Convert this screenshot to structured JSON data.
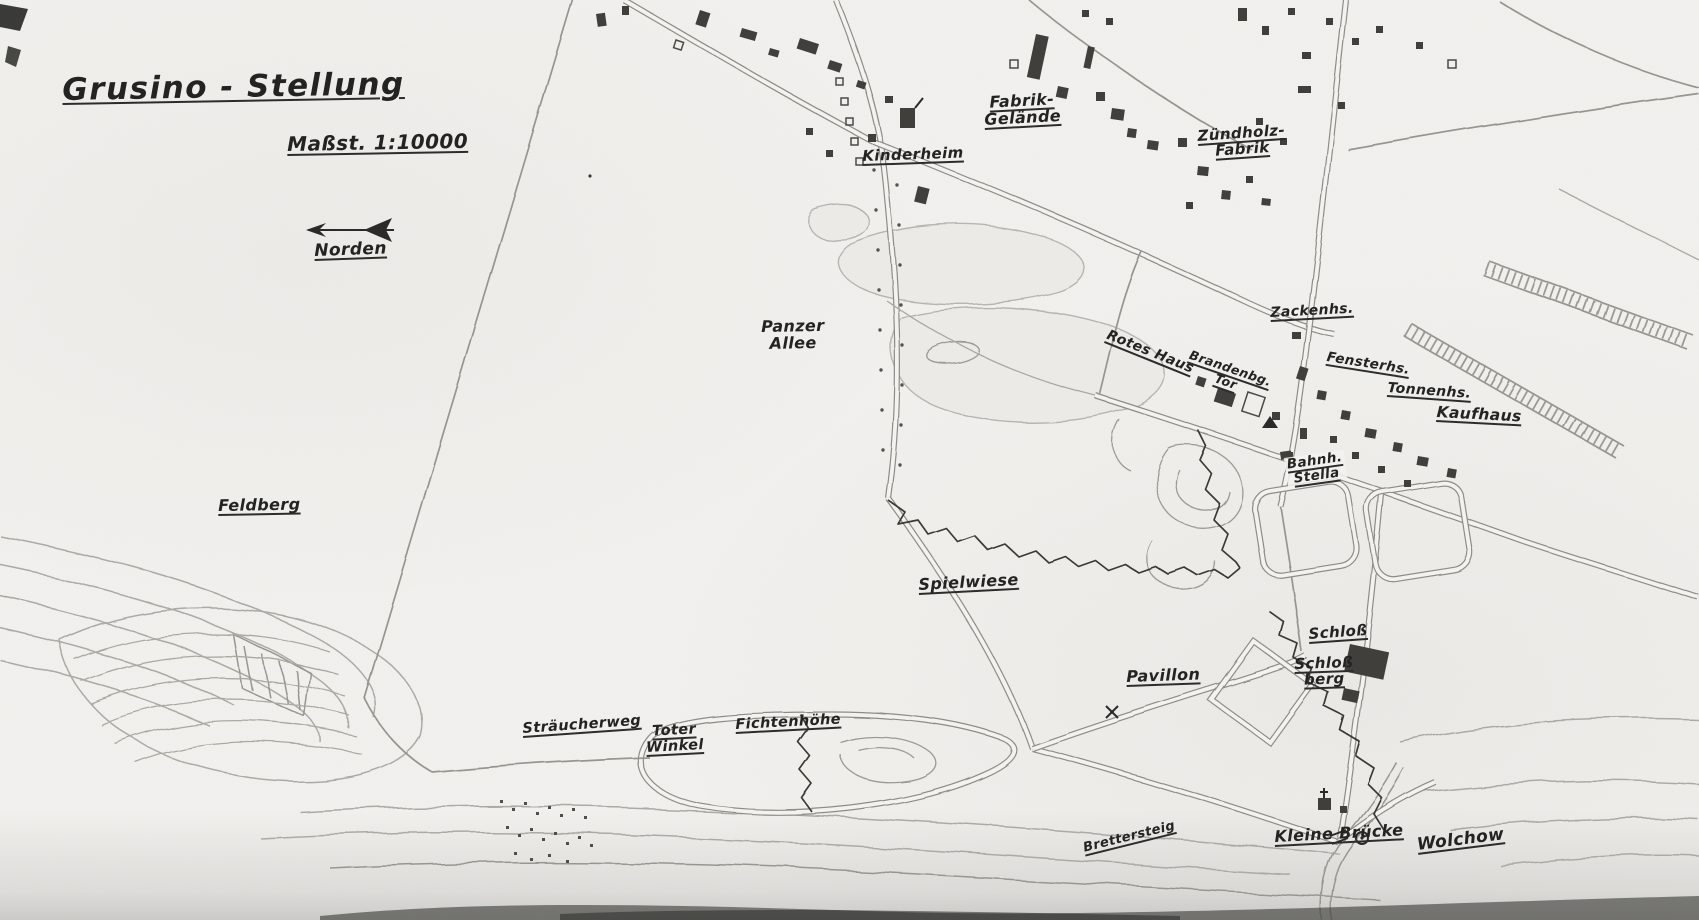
{
  "map": {
    "title": "Grusino - Stellung",
    "scale_label": "Maßst. 1:10000",
    "north_label": "Norden",
    "colors": {
      "paper": "#f3f2ef",
      "ink": "#2a2a28",
      "pencil": "#8d8c87"
    }
  },
  "places": [
    {
      "text": "Kinderheim"
    },
    {
      "text": "Fabrik-\nGelände"
    },
    {
      "text": "Zündholz-\nFabrik"
    },
    {
      "text": "Zackenhs."
    },
    {
      "text": "Rotes Haus"
    },
    {
      "text": "Brandenbg.\nTor"
    },
    {
      "text": "Fensterhs."
    },
    {
      "text": "Tonnenhs."
    },
    {
      "text": "Kaufhaus"
    },
    {
      "text": "Bahnh.\nStella"
    },
    {
      "text": "Panzer\nAllee"
    },
    {
      "text": "Feldberg"
    },
    {
      "text": "Spielwiese"
    },
    {
      "text": "Sträucherweg"
    },
    {
      "text": "Toter\nWinkel"
    },
    {
      "text": "Fichtenhöhe"
    },
    {
      "text": "Pavillon"
    },
    {
      "text": "Schloß"
    },
    {
      "text": "Schloß\nberg"
    },
    {
      "text": "Brettersteig"
    },
    {
      "text": "Kleine Brücke"
    },
    {
      "text": "Wolchow"
    }
  ]
}
